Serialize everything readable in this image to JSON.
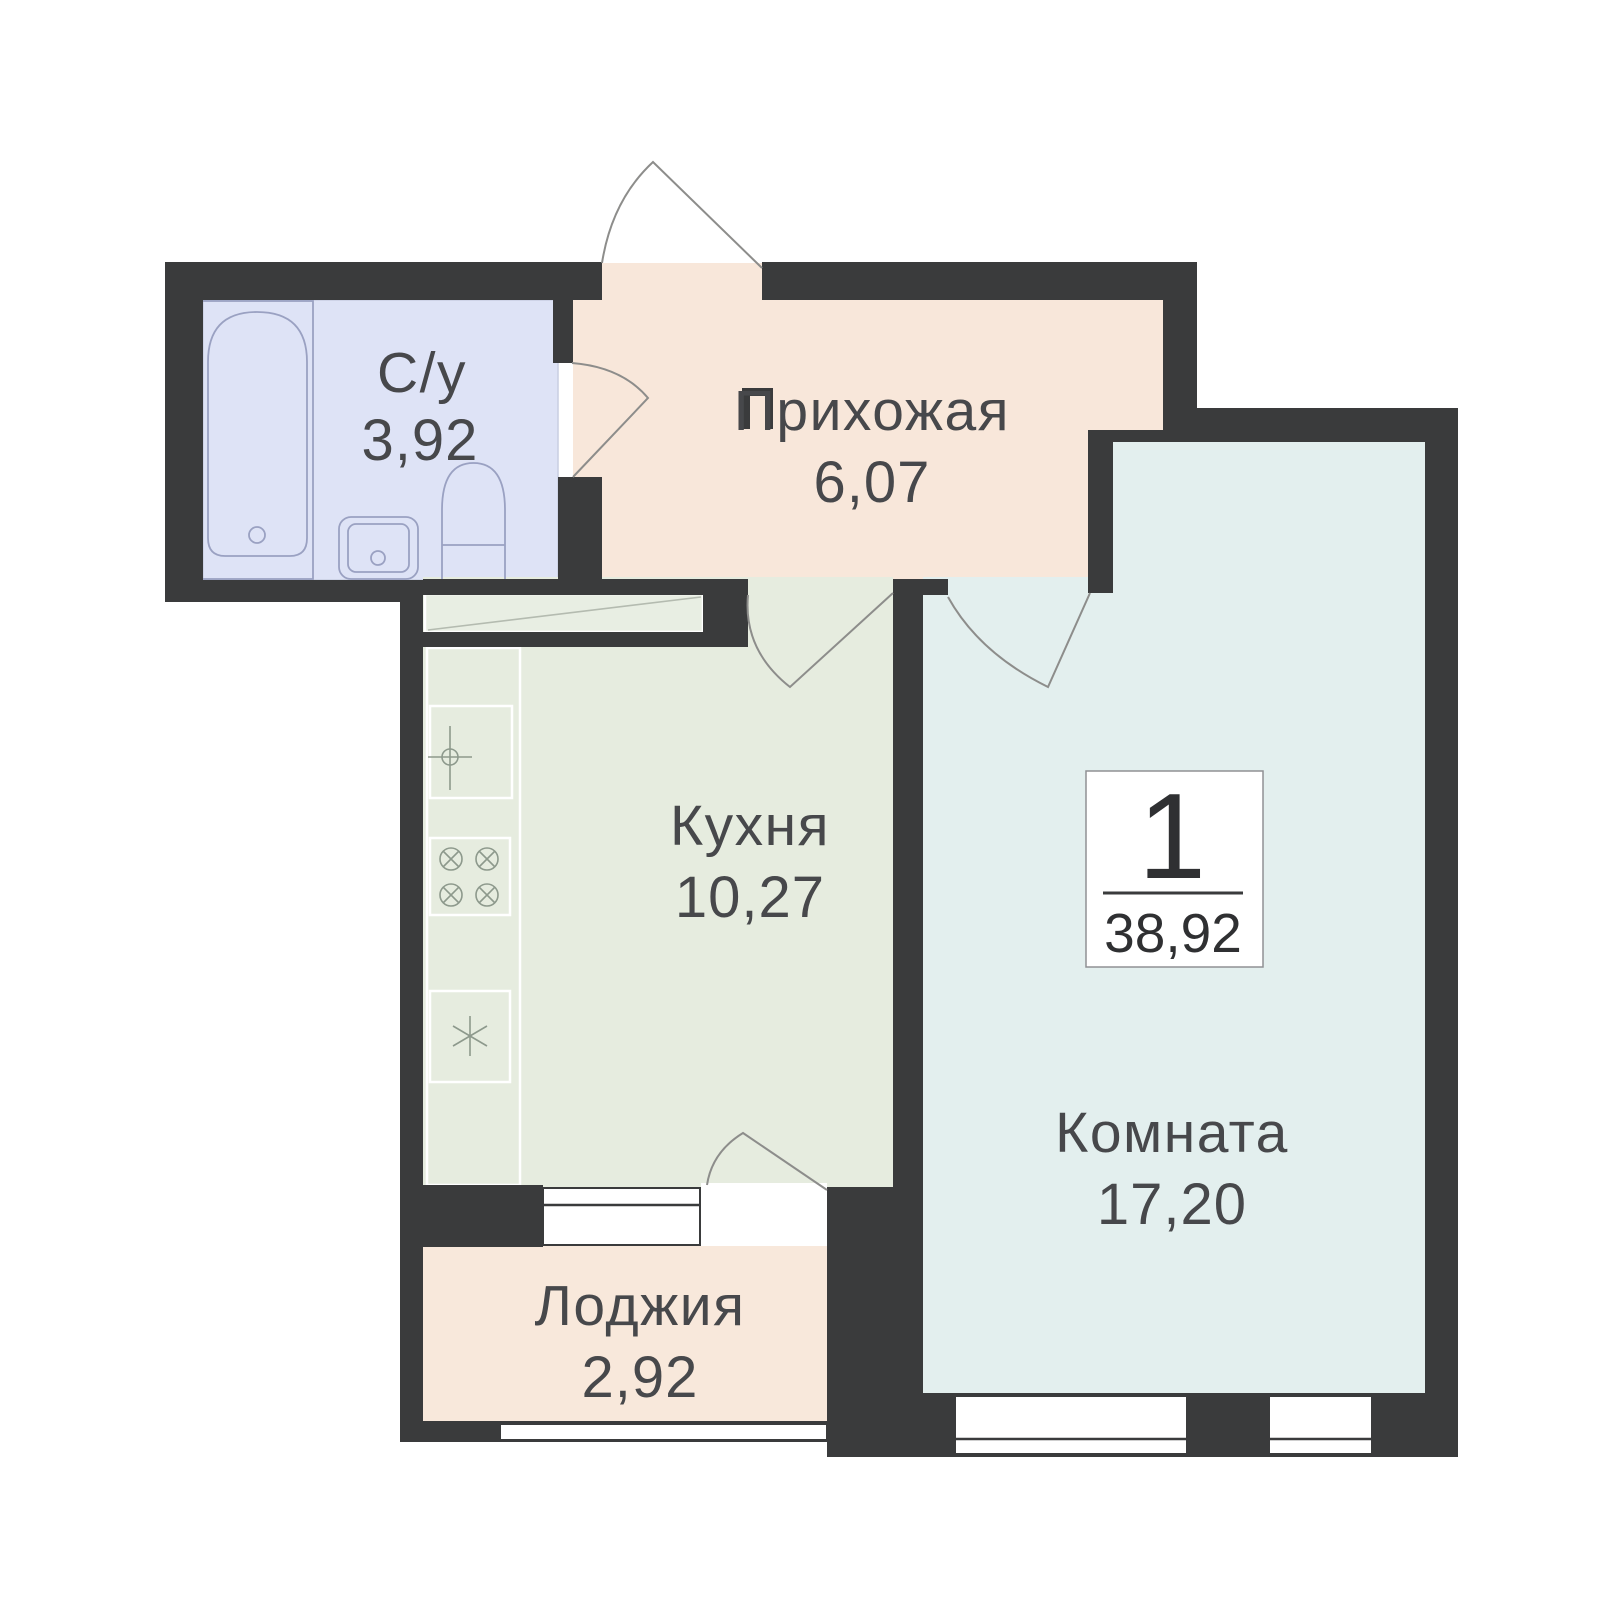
{
  "plan": {
    "title": "apartment-floor-plan",
    "badge": {
      "rooms_count": "1",
      "total_area": "38,92"
    },
    "rooms": {
      "bathroom": {
        "name": "С/у",
        "area": "3,92"
      },
      "hallway": {
        "name": "Прихожая",
        "area": "6,07"
      },
      "kitchen": {
        "name": "Кухня",
        "area": "10,27"
      },
      "living_room": {
        "name": "Комната",
        "area": "17,20"
      },
      "loggia": {
        "name": "Лоджия",
        "area": "2,92"
      }
    },
    "colors": {
      "wall": "#3a3b3c",
      "bathroom_floor": "#dee3f6",
      "hallway_floor": "#f8e7da",
      "kitchen_floor": "#e6ecdf",
      "room_floor": "#e3efee",
      "loggia_floor": "#f8e8db",
      "closet_fill": "#e8eee3",
      "badge_bg": "#ffffff",
      "badge_border": "#909094"
    }
  }
}
